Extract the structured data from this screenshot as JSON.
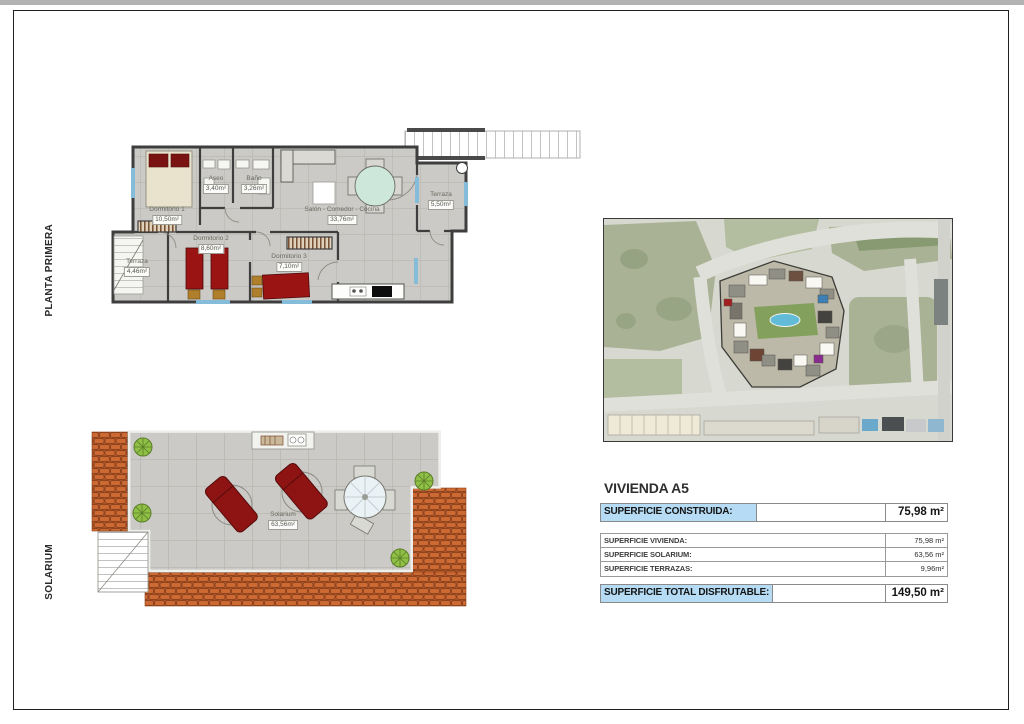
{
  "side_labels": {
    "planta": "PLANTA PRIMERA",
    "solarium": "SOLARIUM"
  },
  "floorplan": {
    "rooms": {
      "dormitorio1": {
        "name": "Dormitorio 1",
        "area": "10,50m²"
      },
      "aseo": {
        "name": "Aseo",
        "area": "3,40m²"
      },
      "bano": {
        "name": "Baño",
        "area": "3,26m²"
      },
      "salon": {
        "name": "Salón - Comedor - Cocina",
        "area": "33,76m²"
      },
      "terraza_derecha": {
        "name": "Terraza",
        "area": "5,50m²"
      },
      "terraza_izquierda": {
        "name": "Terraza",
        "area": "4,46m²"
      },
      "dormitorio2": {
        "name": "Dormitorio 2",
        "area": "8,60m²"
      },
      "dormitorio3": {
        "name": "Dormitorio 3",
        "area": "7,10m²"
      }
    }
  },
  "solarium_plan": {
    "room": {
      "name": "Solarium",
      "area": "63,56m²"
    }
  },
  "info_panel": {
    "title": "VIVIENDA A5",
    "construida": {
      "label": "SUPERFICIE CONSTRUIDA:",
      "value": "75,98 m²"
    },
    "rows": [
      {
        "label": "SUPERFICIE VIVIENDA:",
        "value": "75,98 m²"
      },
      {
        "label": "SUPERFICIE SOLARIUM:",
        "value": "63,56 m²"
      },
      {
        "label": "SUPERFICIE TERRAZAS:",
        "value": "9,96m²"
      }
    ],
    "total": {
      "label": "SUPERFICIE TOTAL DISFRUTABLE:",
      "value": "149,50 m²"
    }
  },
  "colors": {
    "highlight_blue": "#b5dcf4",
    "roof_tile_orange": "#c9672f",
    "bed_red": "#9a1414",
    "pool_blue": "#62bcd8",
    "plant_green": "#7fb33c",
    "floor_gray": "#cbcac6",
    "wall_dark": "#3e3e3e"
  }
}
